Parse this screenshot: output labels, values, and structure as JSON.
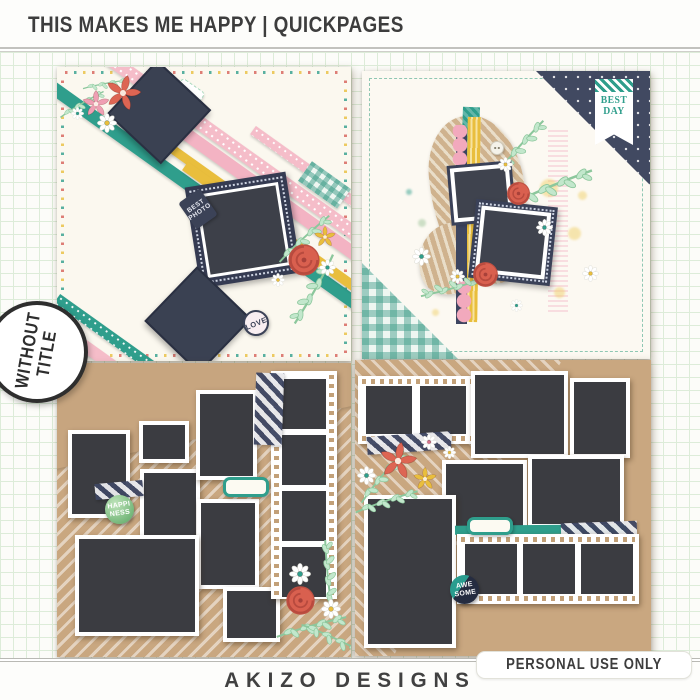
{
  "header": {
    "title": "THIS MAKES ME HAPPY | QUICKPAGES"
  },
  "side_badge": {
    "line1": "WITHOUT",
    "line2": "TITLE"
  },
  "footer": {
    "brand": "AKIZO DESIGNS",
    "license": "PERSONAL USE ONLY"
  },
  "quickpages": {
    "top_left": {
      "best_photo_tag": {
        "line1": "BEST",
        "line2": "PHOTO"
      },
      "love_badge": "LOVE",
      "photo_slots": 3
    },
    "top_right": {
      "best_day_banner": {
        "line1": "BEST",
        "line2": "DAY"
      },
      "photo_slots": 2
    },
    "bottom_left": {
      "happiness_badge": {
        "line1": "HAPPI",
        "line2": "NESS"
      },
      "photo_slots": 11
    },
    "bottom_right": {
      "awesome_badge": {
        "line1": "AWE",
        "line2": "SOME"
      },
      "photo_slots": 11
    }
  },
  "colors": {
    "teal": "#2f9e8c",
    "pink": "#f5bdc9",
    "yellow": "#e9be3d",
    "navy": "#3b4257",
    "coral": "#d9604f",
    "kraft": "#c9a780",
    "cream": "#fbf8ef",
    "photo_placeholder": "#3b3c41",
    "grid_line": "#ddecd9"
  }
}
